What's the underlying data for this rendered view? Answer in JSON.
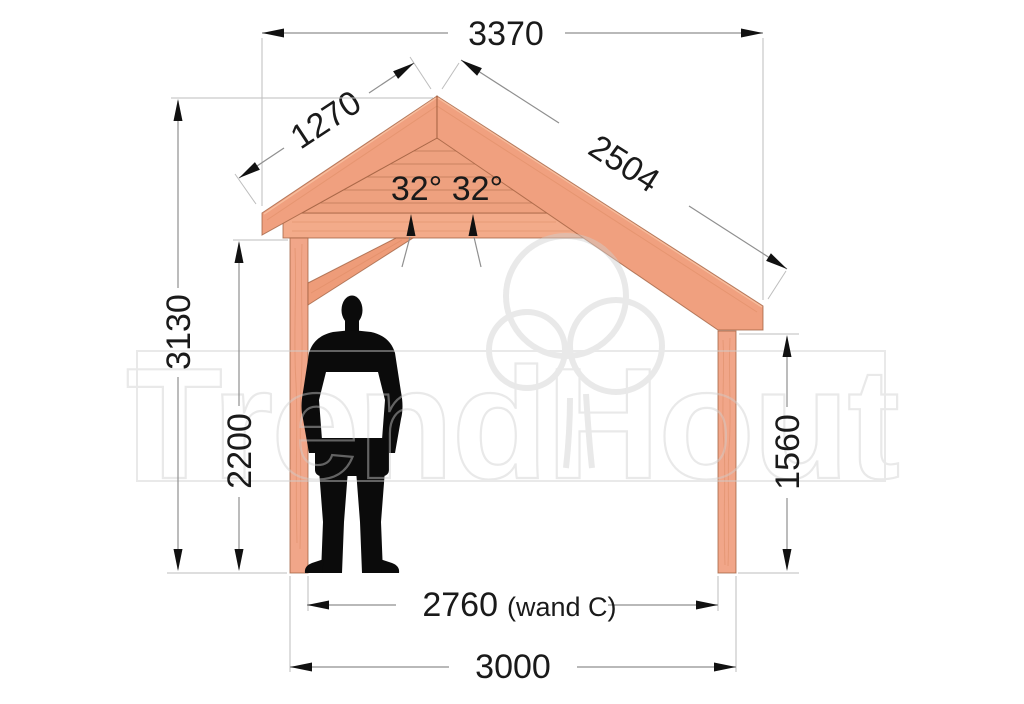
{
  "drawing": {
    "subject": "timber veranda side elevation",
    "units": "mm"
  },
  "watermark": {
    "text": "TrendHout"
  },
  "dimensions": {
    "top_width": "3370",
    "left_roof_slope": "1270",
    "right_roof_slope": "2504",
    "roof_angles": "32° 32°",
    "total_height": "3130",
    "passage_height": "2200",
    "right_post_height": "1560",
    "inner_width": "2760",
    "inner_width_note": "(wand C)",
    "outer_width": "3000"
  },
  "colors": {
    "wood_rafter": "#f0a07f",
    "wood_planks": "#eea17f",
    "wood_beam": "#f3ab8a",
    "wood_post": "#f1a689",
    "wood_brace": "#ee9c79",
    "wood_edge": "#9e5e3e",
    "dimension_line": "#8f8f8f",
    "dimension_text": "#1a1a1a",
    "silhouette": "#0b0b0b",
    "watermark_gray": "#cfcfcf"
  }
}
